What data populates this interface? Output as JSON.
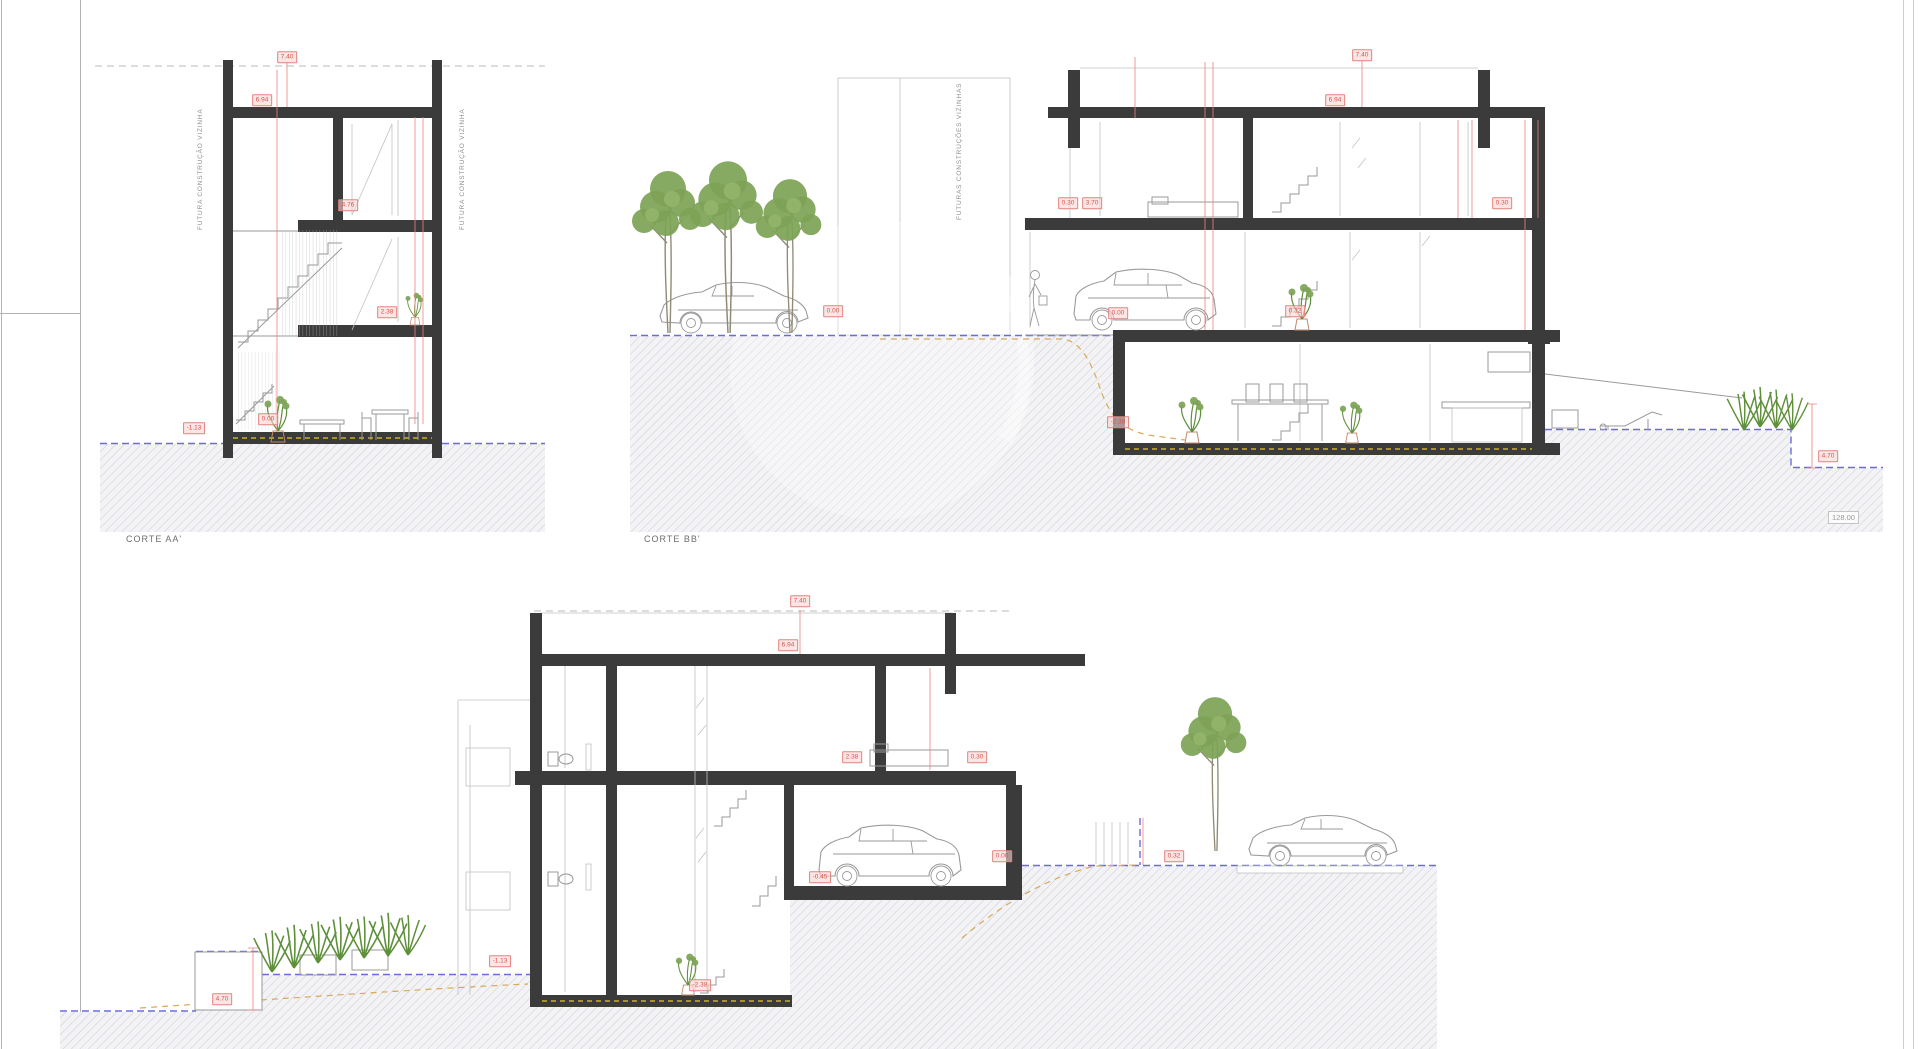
{
  "drawing": {
    "title_labels": {
      "corte_aa": "CORTE AA'",
      "corte_bb": "CORTE BB'"
    },
    "side_texts": [
      {
        "t": "FUTURA CONSTRUÇÃO VIZINHA",
        "x": 197,
        "y": 90,
        "h": 140
      },
      {
        "t": "FUTURA CONSTRUÇÃO VIZINHA",
        "x": 459,
        "y": 90,
        "h": 140
      },
      {
        "t": "FUTURAS CONSTRUÇÕES VIZINHAS",
        "x": 956,
        "y": 72,
        "h": 148
      }
    ],
    "elevation_note": "128.00",
    "dimensions": [
      {
        "v": "7.40",
        "x": 287,
        "y": 57
      },
      {
        "v": "6.94",
        "x": 262,
        "y": 100
      },
      {
        "v": "4.76",
        "x": 348,
        "y": 205
      },
      {
        "v": "2.38",
        "x": 387,
        "y": 312
      },
      {
        "v": "0.00",
        "x": 268,
        "y": 419
      },
      {
        "v": "-1.13",
        "x": 194,
        "y": 428
      },
      {
        "v": "7.40",
        "x": 1362,
        "y": 55
      },
      {
        "v": "6.94",
        "x": 1335,
        "y": 100
      },
      {
        "v": "0.30",
        "x": 1068,
        "y": 203
      },
      {
        "v": "3.70",
        "x": 1092,
        "y": 203
      },
      {
        "v": "0.30",
        "x": 1502,
        "y": 203
      },
      {
        "v": "0.00",
        "x": 833,
        "y": 311
      },
      {
        "v": "0.00",
        "x": 1118,
        "y": 313
      },
      {
        "v": "0.32",
        "x": 1295,
        "y": 311
      },
      {
        "v": "-2.38",
        "x": 1118,
        "y": 422
      },
      {
        "v": "4.70",
        "x": 1828,
        "y": 456
      },
      {
        "v": "7.40",
        "x": 800,
        "y": 601
      },
      {
        "v": "6.94",
        "x": 788,
        "y": 645
      },
      {
        "v": "2.38",
        "x": 852,
        "y": 757
      },
      {
        "v": "0.30",
        "x": 977,
        "y": 757
      },
      {
        "v": "-0.45",
        "x": 820,
        "y": 877
      },
      {
        "v": "0.00",
        "x": 1002,
        "y": 856
      },
      {
        "v": "0.32",
        "x": 1174,
        "y": 856
      },
      {
        "v": "-2.38",
        "x": 700,
        "y": 985
      },
      {
        "v": "-1.13",
        "x": 500,
        "y": 961
      },
      {
        "v": "4.70",
        "x": 222,
        "y": 999
      }
    ],
    "colors": {
      "structure": "#3b3b3b",
      "dimension_red": "#d9534e",
      "terrain_blue": "#6b6bdc",
      "existing_terrain_orange": "#d9a85a",
      "vegetation_green": "#7da356",
      "hatch_gray": "#c9ccd4"
    }
  }
}
